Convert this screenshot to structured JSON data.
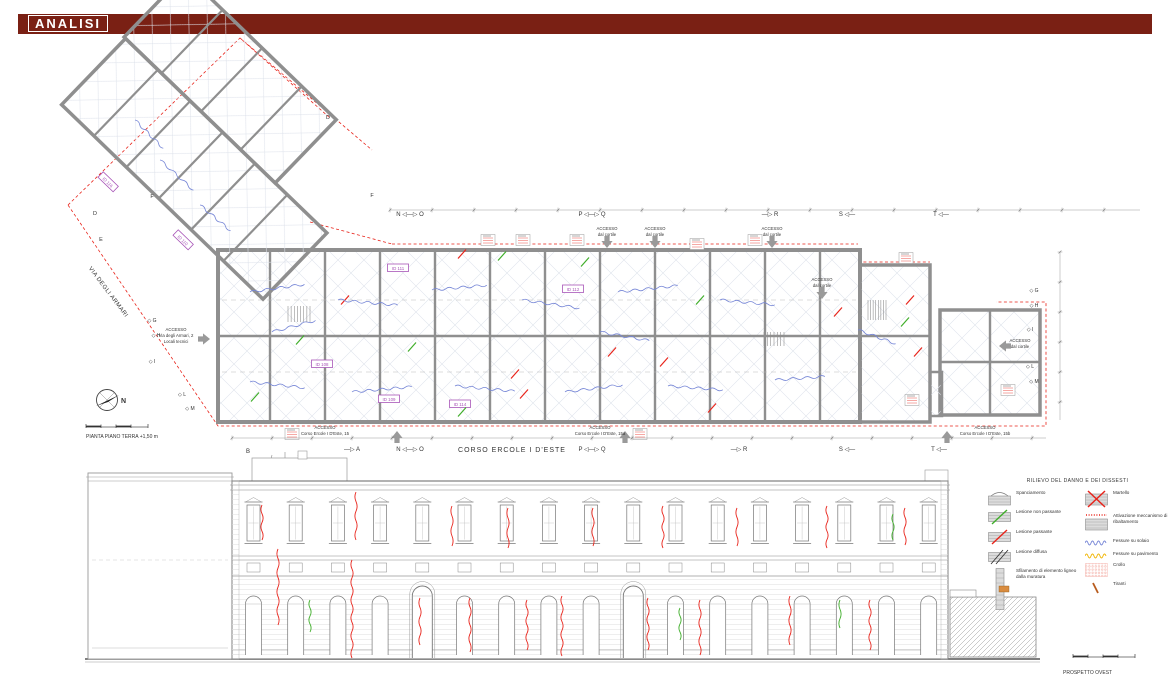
{
  "header": {
    "title": "ANALISI"
  },
  "plan": {
    "caption": "PIANTA PIANO TERRA  +1,50 m",
    "street_left": "VIA DEGLI ARMARI",
    "street_bottom": "CORSO ERCOLE I D'ESTE",
    "north_label": "N"
  },
  "elevation": {
    "caption": "PROSPETTO OVEST",
    "windows": {
      "count": 17,
      "x0": 247,
      "step": 42.2,
      "y": 505,
      "w": 13,
      "h": 36
    },
    "bays": {
      "count": 17,
      "y_top": 590,
      "y_bot": 655,
      "w": 16,
      "door_indices": [
        4,
        9
      ]
    }
  },
  "legend": {
    "title": "RILIEVO DEL DANNO E DEI DISSESTI",
    "left_items": [
      {
        "label": "Spanciamento"
      },
      {
        "label": "Lesione non passante"
      },
      {
        "label": "Lesione passante"
      },
      {
        "label": "Lesione diffusa"
      },
      {
        "label": "Sfilamento di elemento ligneo dalla muratura"
      }
    ],
    "right_items": [
      {
        "label": "Martello"
      },
      {
        "label": "Attivazione meccanismo di ribaltamento"
      },
      {
        "label": "Fessure su solaio"
      },
      {
        "label": "Fessure su pavimento"
      },
      {
        "label": "Crollo"
      },
      {
        "label": "Tiranti"
      }
    ]
  },
  "colors": {
    "header_maroon": "#7a2014",
    "crack_red": "#e8231a",
    "lesion_green": "#3fae2a",
    "floor_crack_blue": "#7585d6",
    "pavement_yellow": "#f0b400",
    "room_id_purple": "#a855b8",
    "wall_gray": "#8f8f8f",
    "tirante_orange": "#b85c1e",
    "crollo_pink": "#f2a9a0"
  },
  "drawing": {
    "texts": [
      {
        "x": 512,
        "y": 452,
        "s": "CORSO ERCOLE I D'ESTE",
        "size": 7,
        "ls": 1,
        "name": "street-label-corso"
      },
      {
        "x": 107,
        "y": 293,
        "s": "VIA DEGLI ARMARI",
        "size": 6,
        "rot": 53,
        "ls": 0.5,
        "name": "street-label-via"
      },
      {
        "x": 86,
        "y": 438,
        "s": "PIANTA PIANO TERRA  +1,50 m",
        "size": 5,
        "anchor": "start",
        "name": "plan-caption"
      },
      {
        "x": 1063,
        "y": 674,
        "s": "PROSPETTO OVEST",
        "size": 5,
        "anchor": "start",
        "name": "elevation-caption"
      },
      {
        "x": 121,
        "y": 403,
        "s": "N",
        "size": 7,
        "bold": true,
        "anchor": "start",
        "name": "north-label"
      },
      {
        "x": 410,
        "y": 216,
        "s": "N ◁—▷ O",
        "size": 6,
        "name": "section-marker"
      },
      {
        "x": 592,
        "y": 216,
        "s": "P ◁—▷ Q",
        "size": 6,
        "name": "section-marker"
      },
      {
        "x": 770,
        "y": 216,
        "s": "—▷ R",
        "size": 6,
        "name": "section-marker"
      },
      {
        "x": 847,
        "y": 216,
        "s": "S ◁—",
        "size": 6,
        "name": "section-marker"
      },
      {
        "x": 941,
        "y": 216,
        "s": "T ◁—",
        "size": 6,
        "name": "section-marker"
      },
      {
        "x": 248,
        "y": 453,
        "s": "B",
        "size": 6,
        "name": "section-marker"
      },
      {
        "x": 352,
        "y": 451,
        "s": "—▷ A",
        "size": 6,
        "name": "section-marker"
      },
      {
        "x": 410,
        "y": 451,
        "s": "N ◁—▷ O",
        "size": 6,
        "name": "section-marker"
      },
      {
        "x": 592,
        "y": 451,
        "s": "P ◁—▷ Q",
        "size": 6,
        "name": "section-marker"
      },
      {
        "x": 739,
        "y": 451,
        "s": "—▷ R",
        "size": 6,
        "name": "section-marker"
      },
      {
        "x": 847,
        "y": 451,
        "s": "S ◁—",
        "size": 6,
        "name": "section-marker"
      },
      {
        "x": 939,
        "y": 451,
        "s": "T ◁—",
        "size": 6,
        "name": "section-marker"
      },
      {
        "x": 95,
        "y": 215,
        "s": "D",
        "size": 5.5,
        "name": "section-letter"
      },
      {
        "x": 101,
        "y": 241,
        "s": "E",
        "size": 5.5,
        "name": "section-letter"
      },
      {
        "x": 152,
        "y": 198,
        "s": "F",
        "size": 5.5,
        "name": "section-letter"
      },
      {
        "x": 328,
        "y": 119,
        "s": "D",
        "size": 5.5,
        "name": "section-letter"
      },
      {
        "x": 372,
        "y": 197,
        "s": "F",
        "size": 5.5,
        "name": "section-letter"
      },
      {
        "x": 152,
        "y": 322,
        "s": "◇ G",
        "size": 5,
        "name": "section-letter"
      },
      {
        "x": 156,
        "y": 337,
        "s": "◇ H",
        "size": 5,
        "name": "section-letter"
      },
      {
        "x": 152,
        "y": 363,
        "s": "◇ I",
        "size": 5,
        "name": "section-letter"
      },
      {
        "x": 182,
        "y": 396,
        "s": "◇ L",
        "size": 5,
        "name": "section-letter"
      },
      {
        "x": 190,
        "y": 410,
        "s": "◇ M",
        "size": 5,
        "name": "section-letter"
      },
      {
        "x": 1034,
        "y": 292,
        "s": "◇ G",
        "size": 5,
        "name": "section-letter"
      },
      {
        "x": 1034,
        "y": 307,
        "s": "◇ H",
        "size": 5,
        "name": "section-letter"
      },
      {
        "x": 1030,
        "y": 331,
        "s": "◇ I",
        "size": 5,
        "name": "section-letter"
      },
      {
        "x": 1030,
        "y": 368,
        "s": "◇ L",
        "size": 5,
        "name": "section-letter"
      },
      {
        "x": 1034,
        "y": 383,
        "s": "◇ M",
        "size": 5,
        "name": "section-letter"
      },
      {
        "x": 607,
        "y": 230,
        "s": "ACCESSO",
        "name": "access-label"
      },
      {
        "x": 607,
        "y": 236,
        "s": "dal cortile",
        "name": "access-label"
      },
      {
        "x": 655,
        "y": 230,
        "s": "ACCESSO",
        "name": "access-label"
      },
      {
        "x": 655,
        "y": 236,
        "s": "dal cortile",
        "name": "access-label"
      },
      {
        "x": 772,
        "y": 230,
        "s": "ACCESSO",
        "name": "access-label"
      },
      {
        "x": 772,
        "y": 236,
        "s": "dal cortile",
        "name": "access-label"
      },
      {
        "x": 822,
        "y": 281,
        "s": "ACCESSO",
        "name": "access-label"
      },
      {
        "x": 822,
        "y": 287,
        "s": "dal cortile",
        "name": "access-label"
      },
      {
        "x": 1020,
        "y": 342,
        "s": "ACCESSO",
        "name": "access-label"
      },
      {
        "x": 1020,
        "y": 348,
        "s": "dal cortile",
        "name": "access-label"
      },
      {
        "x": 176,
        "y": 331,
        "s": "ACCESSO",
        "name": "access-label"
      },
      {
        "x": 176,
        "y": 337,
        "s": "Via degli Armari, 2",
        "name": "access-label"
      },
      {
        "x": 176,
        "y": 343,
        "s": "Locali tecnici",
        "name": "access-label"
      },
      {
        "x": 325,
        "y": 429,
        "s": "ACCESSO",
        "name": "access-label"
      },
      {
        "x": 325,
        "y": 435,
        "s": "Corso Ercole I D'Este, 15",
        "name": "access-label"
      },
      {
        "x": 600,
        "y": 429,
        "s": "ACCESSO",
        "name": "access-label"
      },
      {
        "x": 600,
        "y": 435,
        "s": "Corso Ercole I D'Este, 15a",
        "name": "access-label"
      },
      {
        "x": 985,
        "y": 429,
        "s": "ACCESSO",
        "name": "access-label"
      },
      {
        "x": 985,
        "y": 435,
        "s": "Corso Ercole I D'Este, 15b",
        "name": "access-label"
      }
    ],
    "arrows": [
      {
        "x": 607,
        "y": 245,
        "dir": "d"
      },
      {
        "x": 655,
        "y": 245,
        "dir": "d"
      },
      {
        "x": 772,
        "y": 245,
        "dir": "d"
      },
      {
        "x": 822,
        "y": 296,
        "dir": "d"
      },
      {
        "x": 1002,
        "y": 346,
        "dir": "l"
      },
      {
        "x": 207,
        "y": 339,
        "dir": "r"
      },
      {
        "x": 397,
        "y": 434,
        "dir": "u"
      },
      {
        "x": 625,
        "y": 434,
        "dir": "u"
      },
      {
        "x": 947,
        "y": 434,
        "dir": "u"
      }
    ],
    "room_boxes": [
      {
        "x": 108,
        "y": 182,
        "s": "ID 116",
        "rot": 44
      },
      {
        "x": 183,
        "y": 240,
        "s": "ID 110",
        "rot": 44
      },
      {
        "x": 398,
        "y": 268,
        "s": "ID 111"
      },
      {
        "x": 573,
        "y": 289,
        "s": "ID 112"
      },
      {
        "x": 322,
        "y": 364,
        "s": "ID 108"
      },
      {
        "x": 389,
        "y": 399,
        "s": "ID 109"
      },
      {
        "x": 460,
        "y": 404,
        "s": "ID 114"
      }
    ],
    "note_boxes": [
      {
        "x": 488,
        "y": 240
      },
      {
        "x": 523,
        "y": 240
      },
      {
        "x": 577,
        "y": 240
      },
      {
        "x": 697,
        "y": 244
      },
      {
        "x": 755,
        "y": 240
      },
      {
        "x": 906,
        "y": 258
      },
      {
        "x": 292,
        "y": 434
      },
      {
        "x": 640,
        "y": 434
      },
      {
        "x": 912,
        "y": 400
      },
      {
        "x": 1008,
        "y": 390
      }
    ],
    "cracks": [
      {
        "x": 262,
        "y1": 505,
        "y2": 540,
        "c": "r"
      },
      {
        "x": 278,
        "y1": 549,
        "y2": 625,
        "c": "r"
      },
      {
        "x": 352,
        "y1": 560,
        "y2": 658,
        "c": "r"
      },
      {
        "x": 356,
        "y1": 492,
        "y2": 540,
        "c": "r"
      },
      {
        "x": 420,
        "y1": 598,
        "y2": 645,
        "c": "r"
      },
      {
        "x": 452,
        "y1": 506,
        "y2": 546,
        "c": "r"
      },
      {
        "x": 470,
        "y1": 598,
        "y2": 652,
        "c": "r"
      },
      {
        "x": 508,
        "y1": 508,
        "y2": 548,
        "c": "r"
      },
      {
        "x": 527,
        "y1": 600,
        "y2": 650,
        "c": "r"
      },
      {
        "x": 562,
        "y1": 596,
        "y2": 656,
        "c": "r"
      },
      {
        "x": 593,
        "y1": 508,
        "y2": 546,
        "c": "r"
      },
      {
        "x": 648,
        "y1": 598,
        "y2": 650,
        "c": "r"
      },
      {
        "x": 663,
        "y1": 506,
        "y2": 548,
        "c": "r"
      },
      {
        "x": 700,
        "y1": 600,
        "y2": 655,
        "c": "r"
      },
      {
        "x": 737,
        "y1": 508,
        "y2": 546,
        "c": "r"
      },
      {
        "x": 790,
        "y1": 596,
        "y2": 645,
        "c": "r"
      },
      {
        "x": 827,
        "y1": 506,
        "y2": 548,
        "c": "r"
      },
      {
        "x": 870,
        "y1": 600,
        "y2": 650,
        "c": "r"
      },
      {
        "x": 905,
        "y1": 508,
        "y2": 545,
        "c": "r"
      },
      {
        "x": 310,
        "y1": 600,
        "y2": 632,
        "c": "g"
      },
      {
        "x": 680,
        "y1": 608,
        "y2": 640,
        "c": "g"
      },
      {
        "x": 893,
        "y1": 514,
        "y2": 540,
        "c": "g"
      },
      {
        "x": 840,
        "y1": 600,
        "y2": 628,
        "c": "g"
      }
    ],
    "plan_marks": [
      {
        "x": 300,
        "y": 340,
        "c": "g"
      },
      {
        "x": 412,
        "y": 347,
        "c": "g"
      },
      {
        "x": 462,
        "y": 412,
        "c": "g"
      },
      {
        "x": 502,
        "y": 256,
        "c": "g"
      },
      {
        "x": 700,
        "y": 300,
        "c": "g"
      },
      {
        "x": 255,
        "y": 397,
        "c": "g"
      },
      {
        "x": 585,
        "y": 262,
        "c": "g"
      },
      {
        "x": 905,
        "y": 322,
        "c": "g"
      },
      {
        "x": 345,
        "y": 300,
        "c": "r"
      },
      {
        "x": 515,
        "y": 374,
        "c": "r"
      },
      {
        "x": 524,
        "y": 394,
        "c": "r"
      },
      {
        "x": 612,
        "y": 352,
        "c": "r"
      },
      {
        "x": 664,
        "y": 362,
        "c": "r"
      },
      {
        "x": 838,
        "y": 312,
        "c": "r"
      },
      {
        "x": 918,
        "y": 352,
        "c": "r"
      },
      {
        "x": 462,
        "y": 254,
        "c": "r"
      },
      {
        "x": 712,
        "y": 408,
        "c": "r"
      },
      {
        "x": 910,
        "y": 300,
        "c": "r"
      }
    ],
    "squiggles": [
      {
        "x": 250,
        "y": 292,
        "len": 55,
        "rot": -8
      },
      {
        "x": 338,
        "y": 300,
        "len": 60,
        "rot": 5
      },
      {
        "x": 432,
        "y": 290,
        "len": 55,
        "rot": -5
      },
      {
        "x": 522,
        "y": 300,
        "len": 58,
        "rot": 8
      },
      {
        "x": 618,
        "y": 292,
        "len": 60,
        "rot": -6
      },
      {
        "x": 720,
        "y": 300,
        "len": 55,
        "rot": 5
      },
      {
        "x": 250,
        "y": 382,
        "len": 55,
        "rot": 6
      },
      {
        "x": 352,
        "y": 392,
        "len": 60,
        "rot": -5
      },
      {
        "x": 455,
        "y": 386,
        "len": 60,
        "rot": 5
      },
      {
        "x": 565,
        "y": 392,
        "len": 58,
        "rot": -7
      },
      {
        "x": 668,
        "y": 386,
        "len": 55,
        "rot": 4
      },
      {
        "x": 775,
        "y": 380,
        "len": 50,
        "rot": -4
      },
      {
        "x": 858,
        "y": 330,
        "len": 40,
        "rot": 20
      },
      {
        "x": 272,
        "y": 332,
        "len": 45,
        "rot": -15
      },
      {
        "x": 600,
        "y": 332,
        "len": 50,
        "rot": 10
      },
      {
        "x": 160,
        "y": 160,
        "len": 45,
        "rot": 42
      },
      {
        "x": 200,
        "y": 205,
        "len": 40,
        "rot": 40
      },
      {
        "x": 135,
        "y": 120,
        "len": 40,
        "rot": 45
      }
    ],
    "stairs": [
      {
        "x": 288,
        "y": 306,
        "w": 22,
        "h": 16,
        "n": 7
      },
      {
        "x": 764,
        "y": 332,
        "w": 20,
        "h": 14,
        "n": 6
      },
      {
        "x": 868,
        "y": 300,
        "w": 18,
        "h": 20,
        "n": 7
      }
    ],
    "dims": [
      {
        "x1": 390,
        "y1": 210,
        "x2": 1140,
        "y2": 210,
        "step": 42
      },
      {
        "x1": 232,
        "y1": 438,
        "x2": 1046,
        "y2": 438,
        "step": 40
      },
      {
        "x1": 1060,
        "y1": 252,
        "x2": 1060,
        "y2": 420,
        "step": 30
      }
    ]
  }
}
